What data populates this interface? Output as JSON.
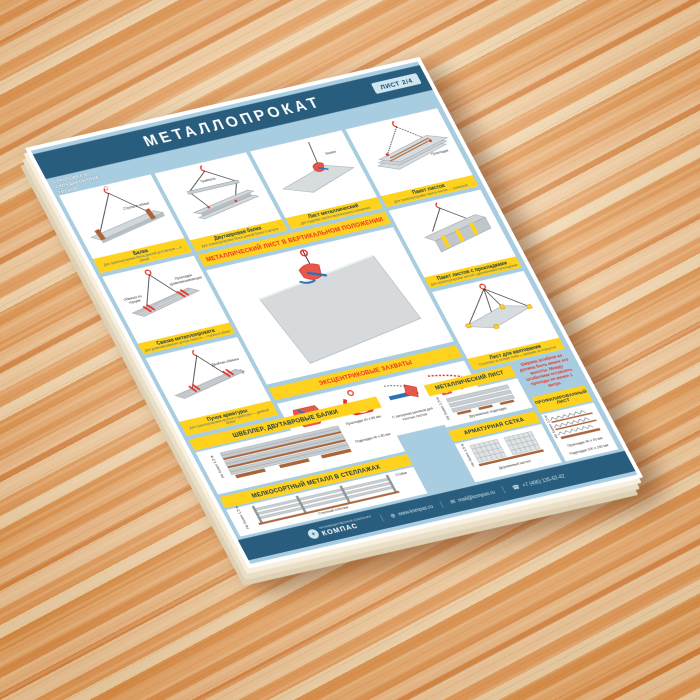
{
  "header": {
    "title": "МЕТАЛЛОПРОКАТ",
    "sheet_badge": "ЛИСТ 2/4",
    "side_label": [
      "СТРОПОВКА И",
      "СКЛАДИРОВАНИЕ",
      "ГРУЗОВ"
    ]
  },
  "bands": {
    "vertical_sheet": "МЕТАЛЛИЧЕСКИЙ ЛИСТ В ВЕРТИКАЛЬНОМ ПОЛОЖЕНИИ",
    "eccentric": "ЭКСЦЕНТРИКОВЫЕ ЗАХВАТЫ"
  },
  "panels": {
    "p1": {
      "caption": "Балка",
      "sub": "Для транспортировки балок длиной до 6 метров — в обхват",
      "label": "Стропы в обхват"
    },
    "p2": {
      "caption": "Двутавровая балка",
      "sub": "Для транспортировки балок длиной более 6 метров",
      "label": "Траверса"
    },
    "p3": {
      "caption": "Лист металлический",
      "sub": "Для подъёма листа в вертикальное положение",
      "label": "Захват"
    },
    "p4": {
      "caption": "Пакет листов",
      "sub": "Для транспортировки пакета листов — траверсой",
      "label": "Прокладки"
    },
    "p5": {
      "caption": "Связка металлопроката",
      "sub": "Для уравновешивания центра тяжести — стропы в обхват",
      "label1": "Обвязка по торцам",
      "label2": "Прокладки уравновешивающие"
    },
    "p6": {
      "caption": "Пучок арматуры",
      "sub": "Для транспортировки прутков и арматуры — двойной обхват",
      "label": "Двойная обвязка"
    },
    "p7": {
      "caption": "Пакет листов с прокладками",
      "sub": "Для транспортировки листов с деревянными прокладками"
    },
    "p8": {
      "caption": "Лист для кантования",
      "sub": "Строповка за четыре точки — крюками за отверстия"
    },
    "clamp1": "С замком, исключающим самопроизвольное раскрытие",
    "clamp2": "С двусторонней установкой на кромку листа",
    "clamp3": "С запорным рычагом для толстых листов",
    "clamp4": "Для стальных листов с горизонтальными зажимами"
  },
  "storage": {
    "sheet": {
      "title": "МЕТАЛЛИЧЕСКИЙ ЛИСТ",
      "height": "Не более 1,5 м",
      "pads": "Деревянные подкладки",
      "warning": "Ширина штабеля не должна быть менее его высоты. Между штабелями оставлять проходы не менее 1 метра"
    },
    "profiled": {
      "title": "ПРОФИЛИРОВАННЫЙ ЛИСТ",
      "height": "Не более 1,5 м",
      "spacers": "Прокладки 40 х 40 мм",
      "pads": "Подкладки 100 х 150 мм"
    },
    "channel": {
      "title": "ШВЕЛЛЕР, ДВУТАВРОВЫЕ БАЛКИ",
      "height": "Не более 1,5 м",
      "spacers": "Прокладки 40 х 80 мм",
      "pads": "Подкладки 40 х 80 мм"
    },
    "mesh": {
      "title": "АРМАТУРНАЯ СЕТКА",
      "height": "Не более 1,5 м",
      "deck": "Деревянный настил"
    },
    "small": {
      "title": "МЕЛКОСОРТНЫЙ МЕТАЛЛ В СТЕЛЛАЖАХ",
      "height": "Не более 1,5 м",
      "posts": "Стойки",
      "rack": "Стоечный стеллаж"
    }
  },
  "footer": {
    "brand": "КОМПАС",
    "tagline": "ПРОИЗВОДСТВЕННАЯ КОМПАНИЯ",
    "website": "www.kompas.ru",
    "email": "mail@kompas.ru",
    "phone": "+7 (495) 135-62-42"
  },
  "colors": {
    "header_blue": "#295d7d",
    "frame_blue": "#a9cde0",
    "accent_yellow": "#ffd21e",
    "accent_red": "#e63329"
  }
}
